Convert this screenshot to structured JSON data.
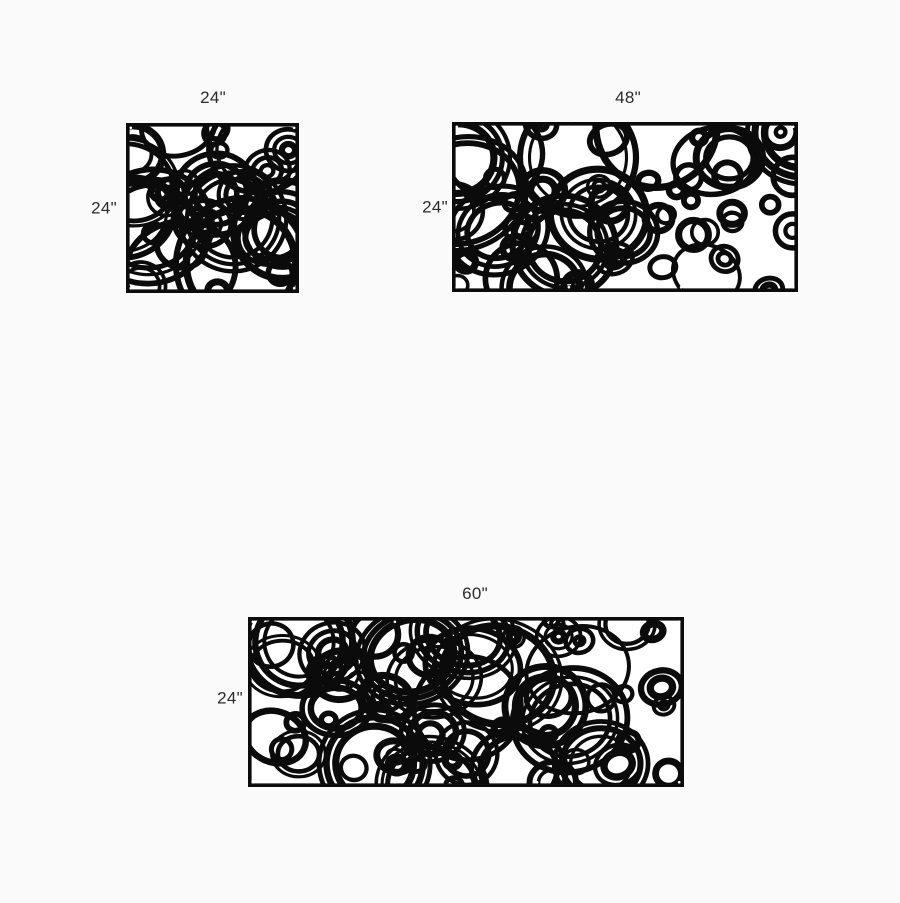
{
  "page": {
    "background": "#fafafa"
  },
  "product": {
    "pattern_name": "overlapping-circles-cutout-screen",
    "panel_color": "#0b0b0b",
    "cutout_color": "#ffffff",
    "label_color": "#2b2b2b"
  },
  "panels": [
    {
      "name": "panel-24x24",
      "width_label": "24\"",
      "height_label": "24\"",
      "width_inches": 24,
      "height_inches": 24,
      "seed": 101,
      "hole_fractions": [
        0,
        1
      ]
    },
    {
      "name": "panel-48x24",
      "width_label": "48\"",
      "height_label": "24\"",
      "width_inches": 48,
      "height_inches": 24,
      "seed": 207,
      "hole_fractions": [
        0,
        0.3333,
        0.6667,
        1
      ]
    },
    {
      "name": "panel-60x24",
      "width_label": "60\"",
      "height_label": "24\"",
      "width_inches": 60,
      "height_inches": 24,
      "seed": 311,
      "hole_fractions": [
        0,
        0.3333,
        0.6667,
        1
      ]
    }
  ]
}
